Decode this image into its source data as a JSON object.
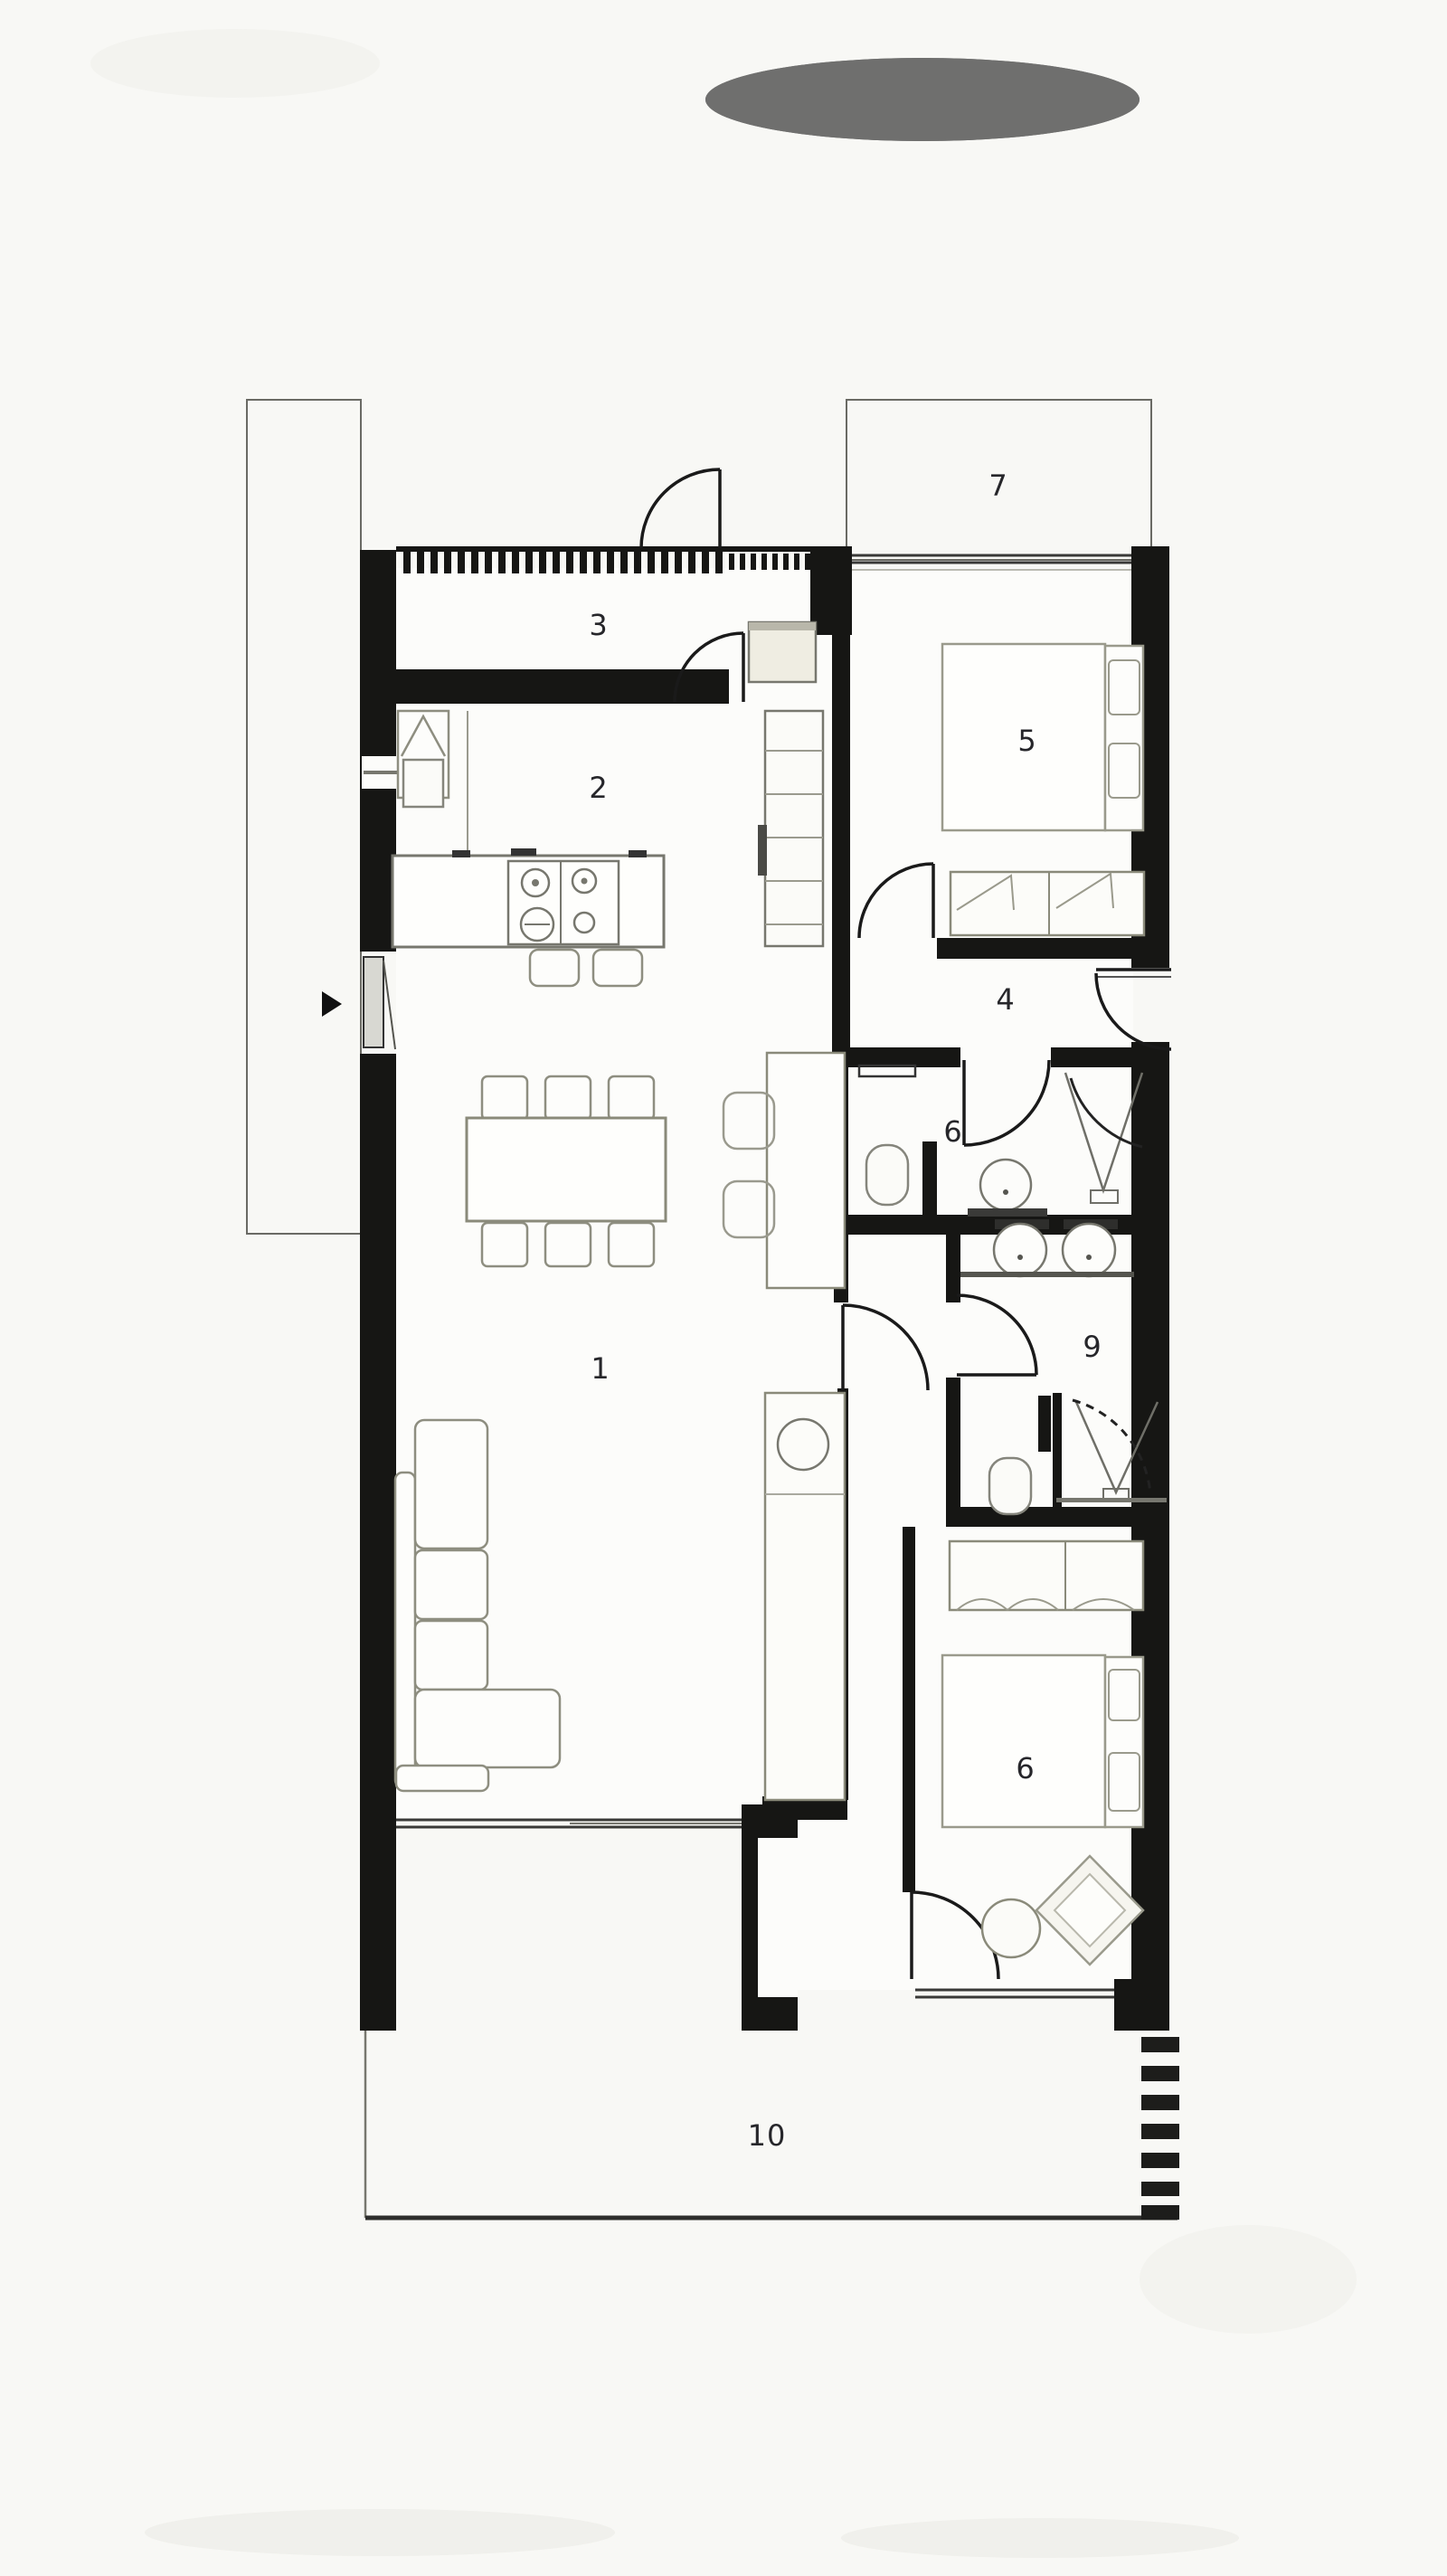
{
  "plan": {
    "type": "residential-floor-plan",
    "description": "Single-storey apartment plan, top-down, black poché walls",
    "label_count": 10
  },
  "colors": {
    "background": "#f8f8f5",
    "floor": "#fcfcfa",
    "wall": "#161614",
    "furniture_stroke": "#8e8e80",
    "door_stroke": "#1a1a1a",
    "label": "#26262a",
    "outline_thin": "#6a6a64"
  },
  "rooms": [
    {
      "name": "living-dining",
      "label": "1"
    },
    {
      "name": "kitchen",
      "label": "2"
    },
    {
      "name": "entry-hall",
      "label": "3"
    },
    {
      "name": "hallway",
      "label": "4"
    },
    {
      "name": "bedroom-primary",
      "label": "5"
    },
    {
      "name": "bathroom",
      "label": "6"
    },
    {
      "name": "upper-terrace",
      "label": "7"
    },
    {
      "name": "bedroom-secondary",
      "label": "6"
    },
    {
      "name": "ensuite",
      "label": "9"
    },
    {
      "name": "lower-terrace",
      "label": "10"
    }
  ]
}
